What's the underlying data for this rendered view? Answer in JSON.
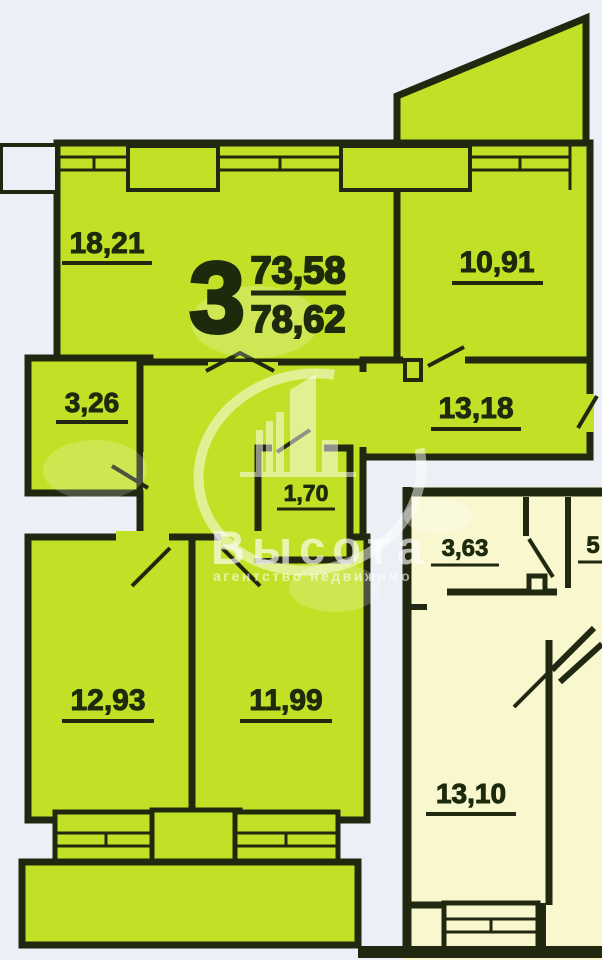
{
  "plan": {
    "summary": {
      "rooms_count": "3",
      "area_upper": "73,58",
      "area_lower": "78,62"
    },
    "main_apartment_rooms": [
      {
        "id": "living-room",
        "area": "18,21"
      },
      {
        "id": "bedroom-right",
        "area": "10,91"
      },
      {
        "id": "hallway",
        "area": "13,18"
      },
      {
        "id": "bathroom",
        "area": "3,26"
      },
      {
        "id": "closet",
        "area": "1,70"
      },
      {
        "id": "bedroom-bottom-left",
        "area": "12,93"
      },
      {
        "id": "bedroom-bottom-middle",
        "area": "11,99"
      }
    ],
    "adjacent_apartment_rooms": [
      {
        "id": "adjacent-hall",
        "area": "3,63"
      },
      {
        "id": "adjacent-partial-right",
        "area": "5"
      },
      {
        "id": "adjacent-room",
        "area": "13,10"
      }
    ]
  },
  "watermark": {
    "title": "Высота",
    "subtitle": "агентство недвижимо"
  },
  "colors": {
    "apartment_fill": "#c2e126",
    "adjacent_apartment_fill": "#f8f7cd",
    "wall": "#20290f",
    "background": "#edeff6",
    "label_text": "#1d2a0c",
    "watermark": "#ffffff"
  }
}
